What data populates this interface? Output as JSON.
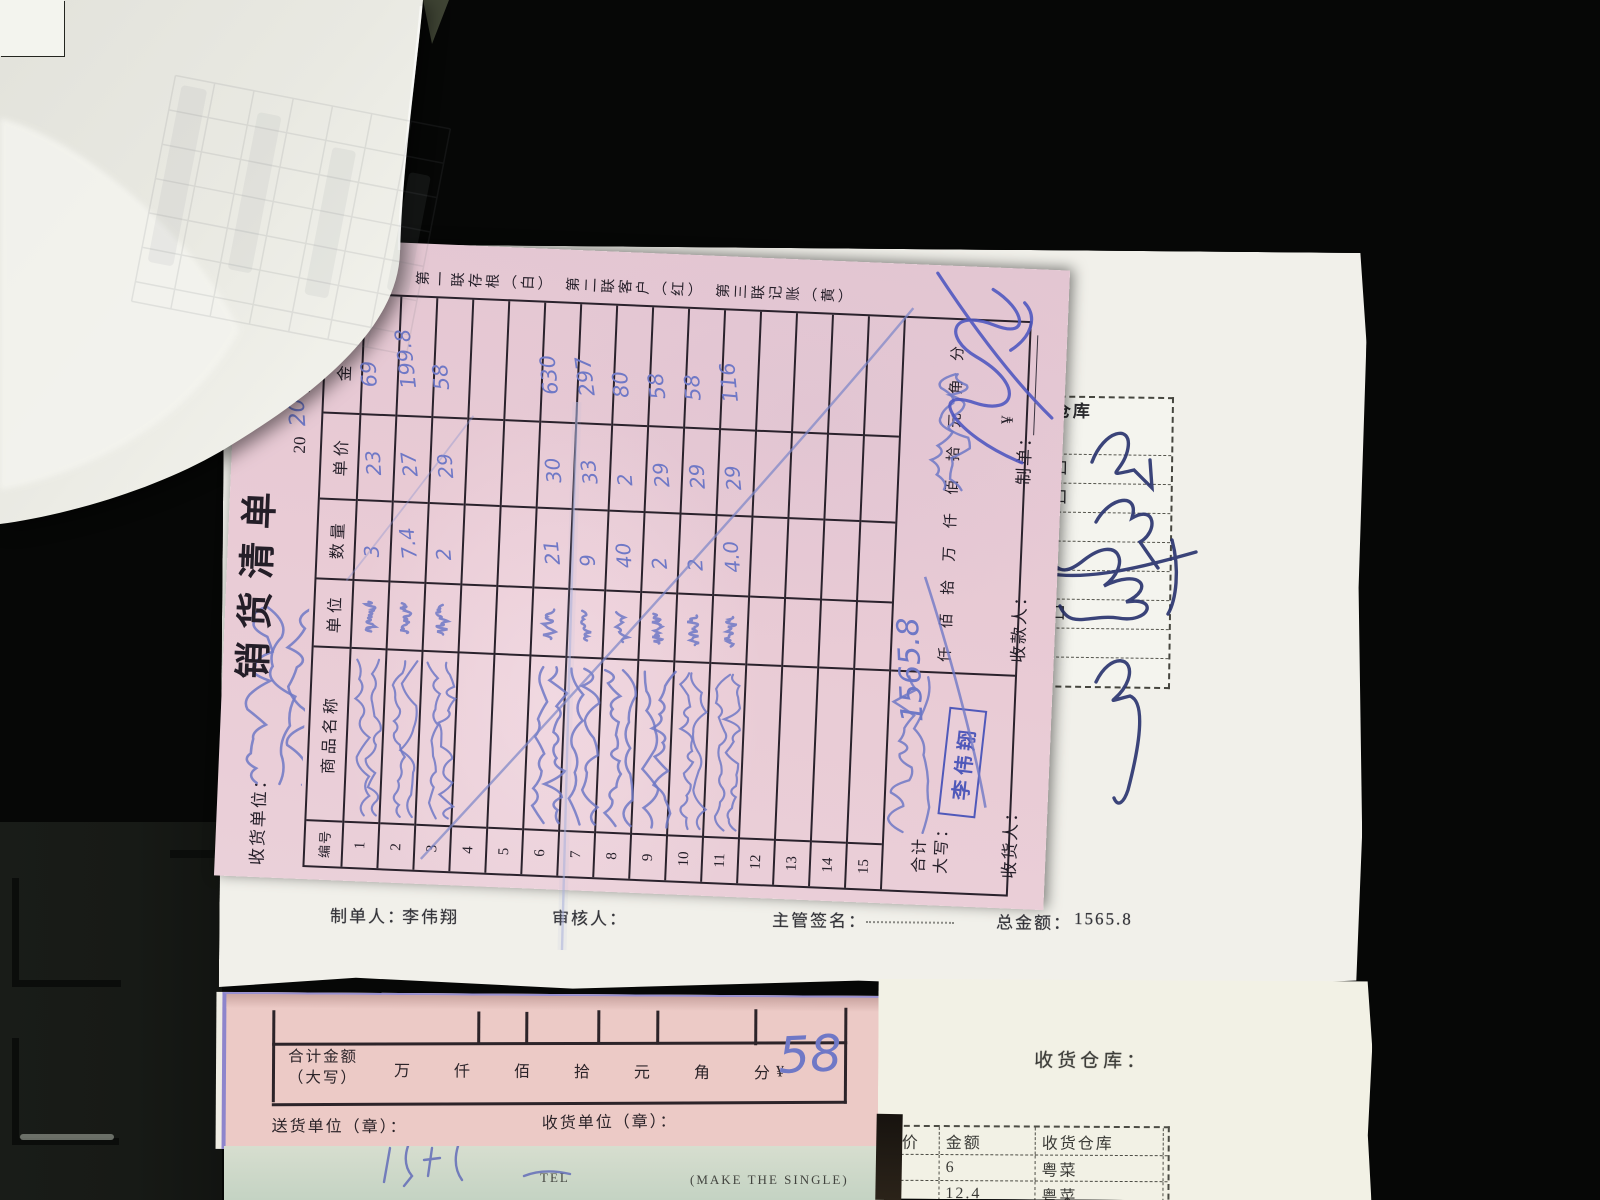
{
  "main_form": {
    "customer_label": "收货单位：",
    "title": "销货清单",
    "serial_prefix": "№",
    "serial_red": "0",
    "year_printed": "20",
    "year_handwritten": "20",
    "year_suffix": "年",
    "copies_note": "第一联存根（白）　第二联客户（红）　第三联记账（黄）",
    "columns": [
      "编号",
      "商品名称",
      "单位",
      "数量",
      "单价",
      "金额"
    ],
    "name_note": "illegible cursive handwriting in 商品名称 / 单位 / customer fields",
    "items": [
      {
        "no": "1",
        "qty": "3",
        "price": "23",
        "amount": "69",
        "handwritten_name": true
      },
      {
        "no": "2",
        "qty": "7.4",
        "price": "27",
        "amount": "199.8",
        "handwritten_name": true
      },
      {
        "no": "3",
        "qty": "2",
        "price": "29",
        "amount": "58",
        "handwritten_name": true
      },
      {
        "no": "4",
        "qty": "",
        "price": "",
        "amount": "",
        "handwritten_name": false
      },
      {
        "no": "5",
        "qty": "",
        "price": "",
        "amount": "",
        "handwritten_name": false
      },
      {
        "no": "6",
        "qty": "21",
        "price": "30",
        "amount": "630",
        "handwritten_name": true
      },
      {
        "no": "7",
        "qty": "9",
        "price": "33",
        "amount": "297",
        "handwritten_name": true
      },
      {
        "no": "8",
        "qty": "40",
        "price": "2",
        "amount": "80",
        "handwritten_name": true
      },
      {
        "no": "9",
        "qty": "2",
        "price": "29",
        "amount": "58",
        "handwritten_name": true
      },
      {
        "no": "10",
        "qty": "2",
        "price": "29",
        "amount": "58",
        "handwritten_name": true
      },
      {
        "no": "11",
        "qty": "4.0",
        "price": "29",
        "amount": "116",
        "handwritten_name": true
      },
      {
        "no": "12",
        "qty": "",
        "price": "",
        "amount": "",
        "handwritten_name": false
      },
      {
        "no": "13",
        "qty": "",
        "price": "",
        "amount": "",
        "handwritten_name": false
      },
      {
        "no": "14",
        "qty": "",
        "price": "",
        "amount": "",
        "handwritten_name": false
      },
      {
        "no": "15",
        "qty": "",
        "price": "",
        "amount": "",
        "handwritten_name": false
      }
    ],
    "total_row": {
      "label_line1": "合计",
      "label_line2": "大写：",
      "scale_chars": [
        "仟",
        "佰",
        "拾",
        "万",
        "仟",
        "佰",
        "拾",
        "元",
        "角",
        "分"
      ],
      "currency": "¥",
      "total_handwritten": "1565.8"
    },
    "stamp": "李伟翔",
    "footer": {
      "receiver_label": "收货人：",
      "payee_label": "收款人：",
      "preparer_label": "制单："
    }
  },
  "white_sheet": {
    "warehouse_table": {
      "header": "收货仓库",
      "rows": [
        "菜",
        "卖档口",
        "卖档口",
        "派",
        "派",
        "派",
        "卖档口",
        "工餐",
        "工餐"
      ]
    },
    "footer": {
      "preparer_label": "制单人：",
      "preparer_name": "李伟翔",
      "reviewer_label": "审核人：",
      "supervisor_label": "主管签名：",
      "total_label": "总金额：",
      "total_value": "1565.8"
    }
  },
  "bottom_form": {
    "total_label_line1": "合计金额",
    "total_label_line2": "（大写）",
    "scale_chars": [
      "万",
      "仟",
      "佰",
      "拾",
      "元",
      "角",
      "分"
    ],
    "currency": "¥",
    "amount_handwritten": "58",
    "sender_label": "送货单位（章）：",
    "receiver_label": "收货单位（章）："
  },
  "green_strip": {
    "tel": "TEL",
    "note": "(MAKE THE SINGLE)"
  },
  "right_paper": {
    "warehouse_label": "收货仓库：",
    "table": {
      "headers": [
        "价",
        "金额",
        "收货仓库"
      ],
      "rows": [
        {
          "price": "",
          "amount": "6",
          "warehouse": "粤菜"
        },
        {
          "price": "",
          "amount": "12.4",
          "warehouse": "粤菜"
        }
      ]
    }
  },
  "colors": {
    "handwriting_blue": "#6f78c6",
    "signature_navy": "#2b3570",
    "stamp_blue": "#4450b8",
    "pink_paper": "#e9cbd5",
    "red_serial": "#c03a30"
  }
}
